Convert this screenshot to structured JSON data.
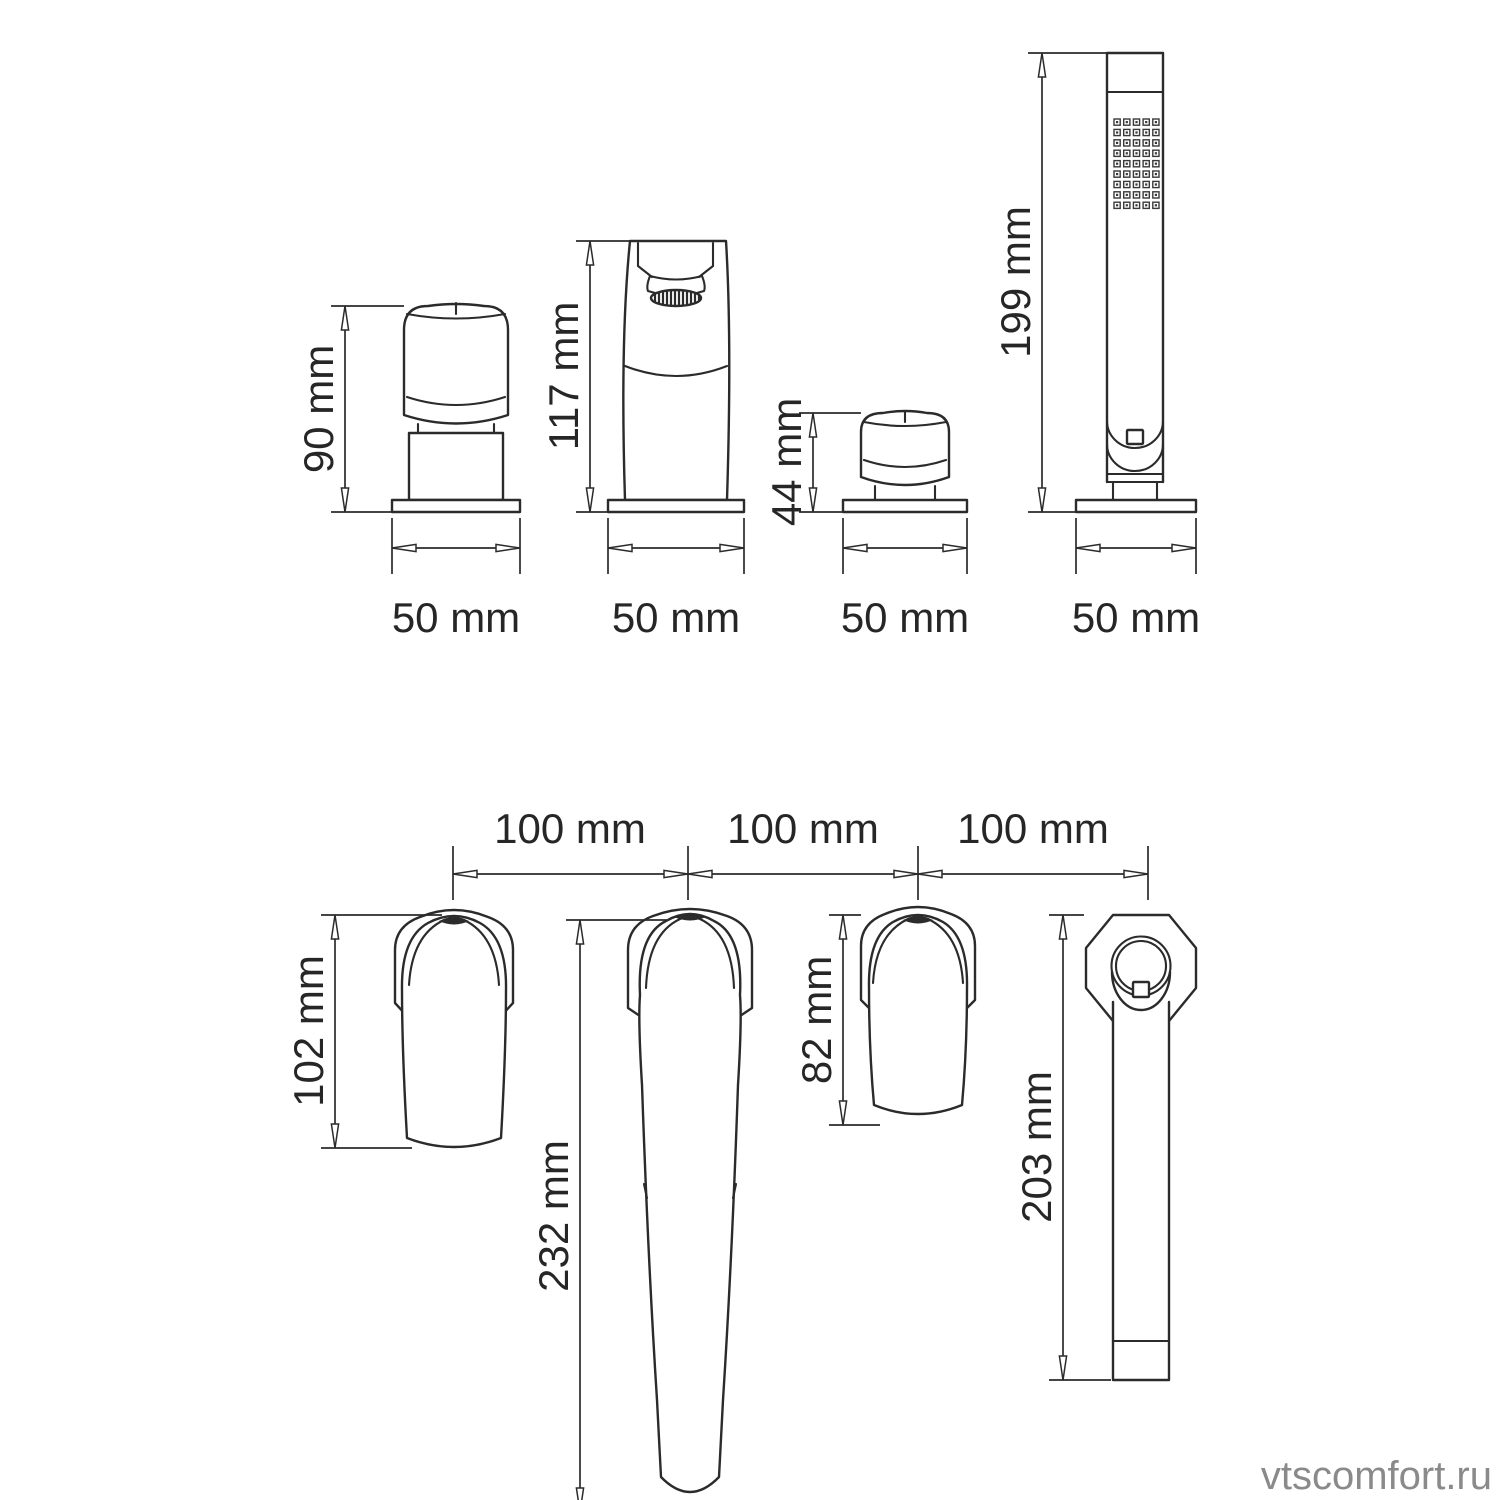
{
  "drawing": {
    "line_color": "#2b2b2b",
    "watermark_color": "#8a8a8a",
    "background": "#ffffff"
  },
  "front_view": {
    "items": [
      {
        "name": "left-handle",
        "height": "90 mm",
        "width": "50 mm"
      },
      {
        "name": "spout",
        "height": "117 mm",
        "width": "50 mm"
      },
      {
        "name": "right-handle",
        "height": "44 mm",
        "width": "50 mm"
      },
      {
        "name": "hand-shower",
        "height": "199 mm",
        "width": "50 mm"
      }
    ]
  },
  "top_view": {
    "spacings": [
      "100 mm",
      "100 mm",
      "100 mm"
    ],
    "items": [
      {
        "name": "left-handle",
        "length": "102 mm"
      },
      {
        "name": "spout",
        "length": "232 mm"
      },
      {
        "name": "right-handle",
        "length": "82 mm"
      },
      {
        "name": "hand-shower",
        "length": "203 mm"
      }
    ]
  },
  "watermark": "vtscomfort.ru"
}
